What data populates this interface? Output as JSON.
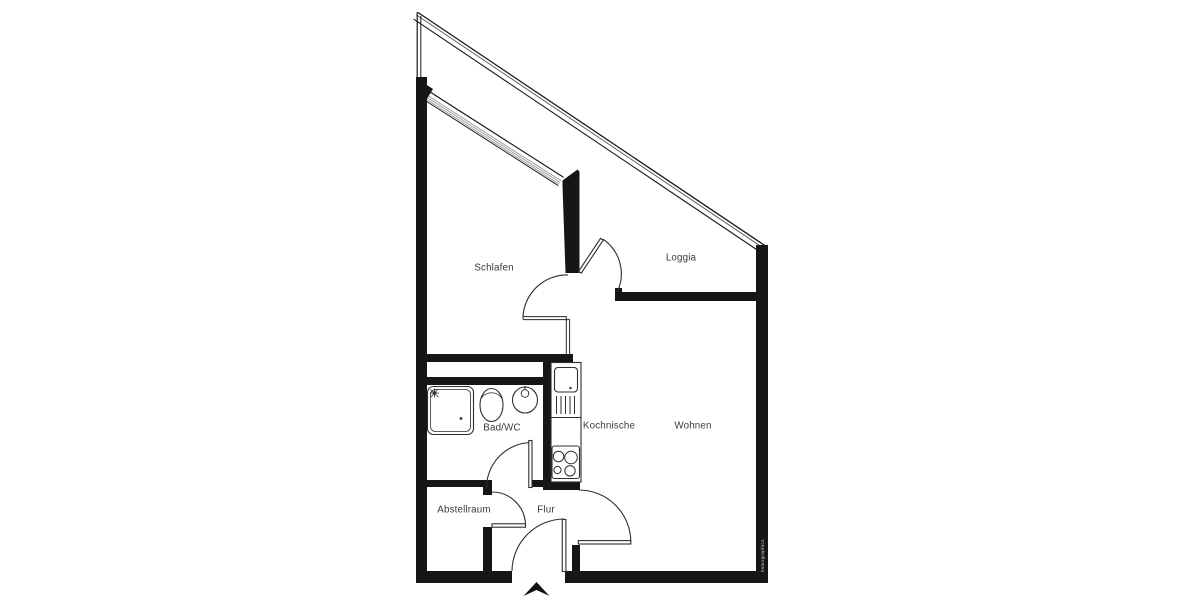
{
  "plan": {
    "rooms": [
      {
        "id": "schlafen",
        "label": "Schlafen"
      },
      {
        "id": "loggia",
        "label": "Loggia"
      },
      {
        "id": "bad-wc",
        "label": "Bad/WC"
      },
      {
        "id": "kochnische",
        "label": "Kochnische"
      },
      {
        "id": "wohnen",
        "label": "Wohnen"
      },
      {
        "id": "abstellraum",
        "label": "Abstellraum"
      },
      {
        "id": "flur",
        "label": "Flur"
      }
    ],
    "watermark": "immographics",
    "icons": [
      "north-arrow-icon",
      "shower-head-icon",
      "faucet-icon"
    ],
    "colors": {
      "wall": "#161616",
      "line": "#2e2e2e",
      "glazing": "#9a9a9a",
      "label": "#3a3a3a",
      "background": "#ffffff"
    }
  }
}
